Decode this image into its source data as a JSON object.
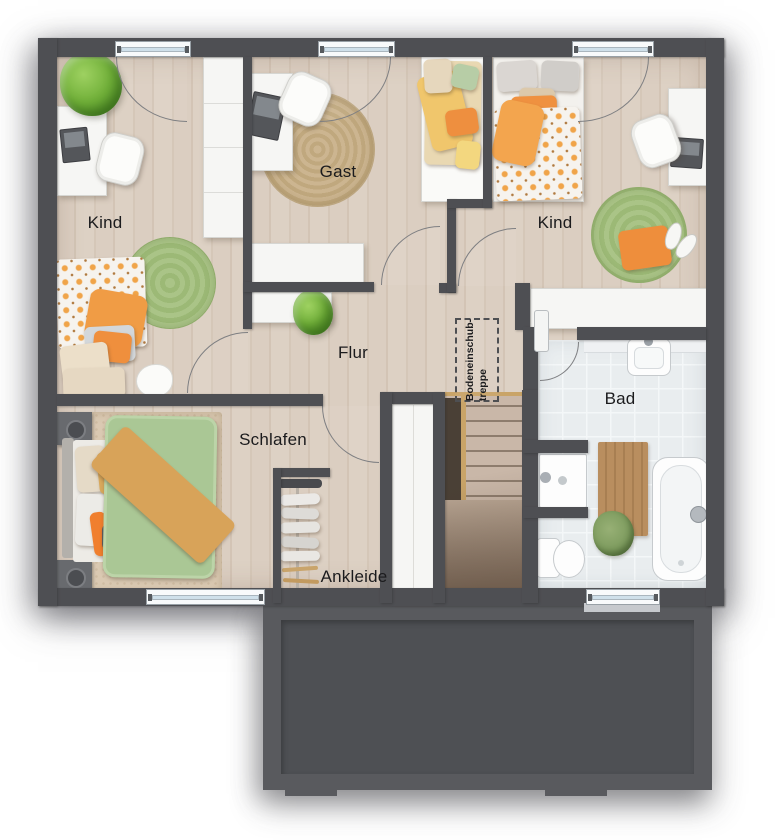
{
  "floorplan": {
    "rooms": [
      {
        "id": "kind-left",
        "label": "Kind"
      },
      {
        "id": "gast",
        "label": "Gast"
      },
      {
        "id": "kind-right",
        "label": "Kind"
      },
      {
        "id": "flur",
        "label": "Flur"
      },
      {
        "id": "bad",
        "label": "Bad"
      },
      {
        "id": "schlafen",
        "label": "Schlafen"
      },
      {
        "id": "ankleide",
        "label": "Ankleide"
      }
    ],
    "attic_hatch": {
      "line1": "Bodeneinschub-",
      "line2": "treppe"
    }
  },
  "colors": {
    "wall": "#4e4f53",
    "floor": "#d9cbbd",
    "tile": "#e9edef",
    "furniture-white": "#f6f6f4",
    "orange": "#ee8f3d",
    "duvet-green": "#aac795",
    "rug-green-a": "#aac487",
    "jute-a": "#ccb590",
    "roof": "#595a5e",
    "text": "#1b1b1d"
  }
}
